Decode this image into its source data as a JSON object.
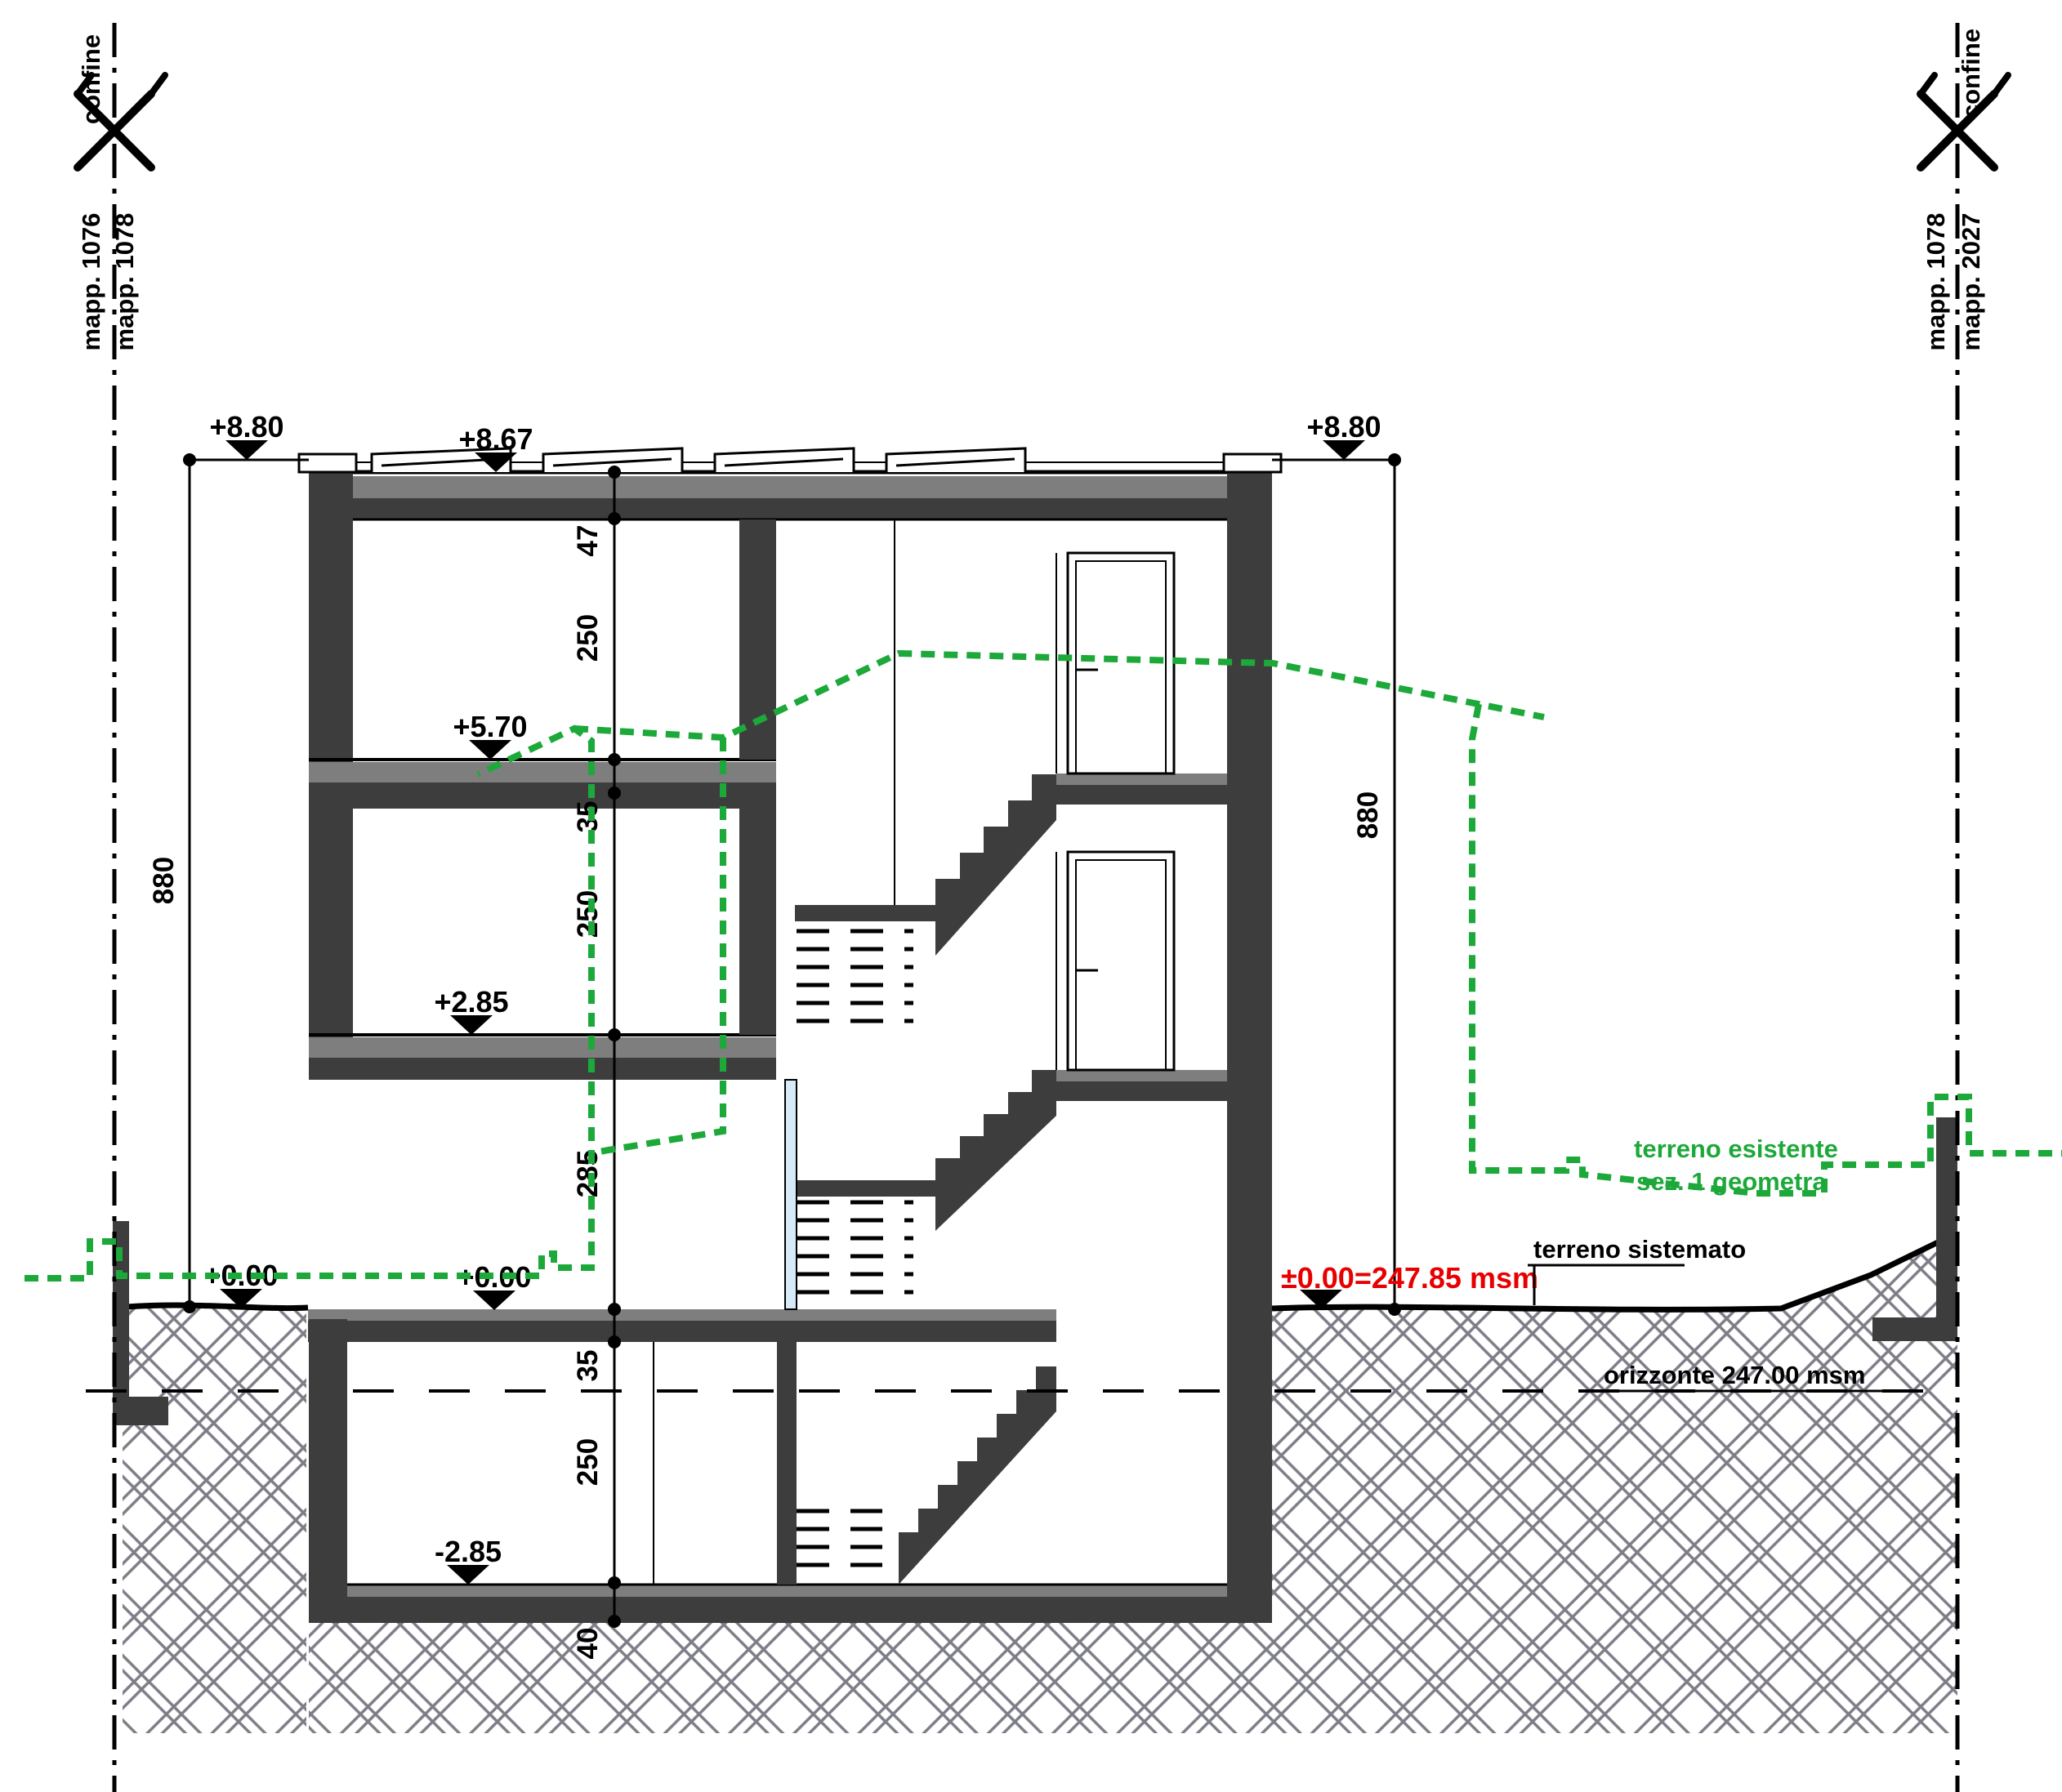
{
  "drawing": {
    "boundary_left": {
      "confine": "confine",
      "parcel_left": "mapp. 1076",
      "parcel_right": "mapp. 1078"
    },
    "boundary_right": {
      "confine": "confine",
      "parcel_left": "mapp. 1078",
      "parcel_right": "mapp. 2027"
    },
    "levels": {
      "roof_left": "+8.80",
      "roof_top": "+8.67",
      "roof_right": "+8.80",
      "floor2": "+5.70",
      "floor1": "+2.85",
      "ground_a": "+0.00",
      "ground_b": "+0.00",
      "basement": "-2.85",
      "datum_red": "±0.00=247.85 msm"
    },
    "dims": {
      "total_left": "880",
      "total_right": "880",
      "chain": [
        "47",
        "250",
        "35",
        "250",
        "285",
        "35",
        "250",
        "40"
      ]
    },
    "terrain": {
      "existing1": "terreno esistente",
      "existing2": "sez. 1 geometra",
      "sistemato": "terreno sistemato",
      "orizzonte": "orizzonte 247.00 msm"
    },
    "colors": {
      "terrain_green": "#1da83a",
      "datum_red": "#e80000",
      "wall_dark": "#3d3d3d",
      "screed_gray": "#7e7e7e"
    }
  }
}
